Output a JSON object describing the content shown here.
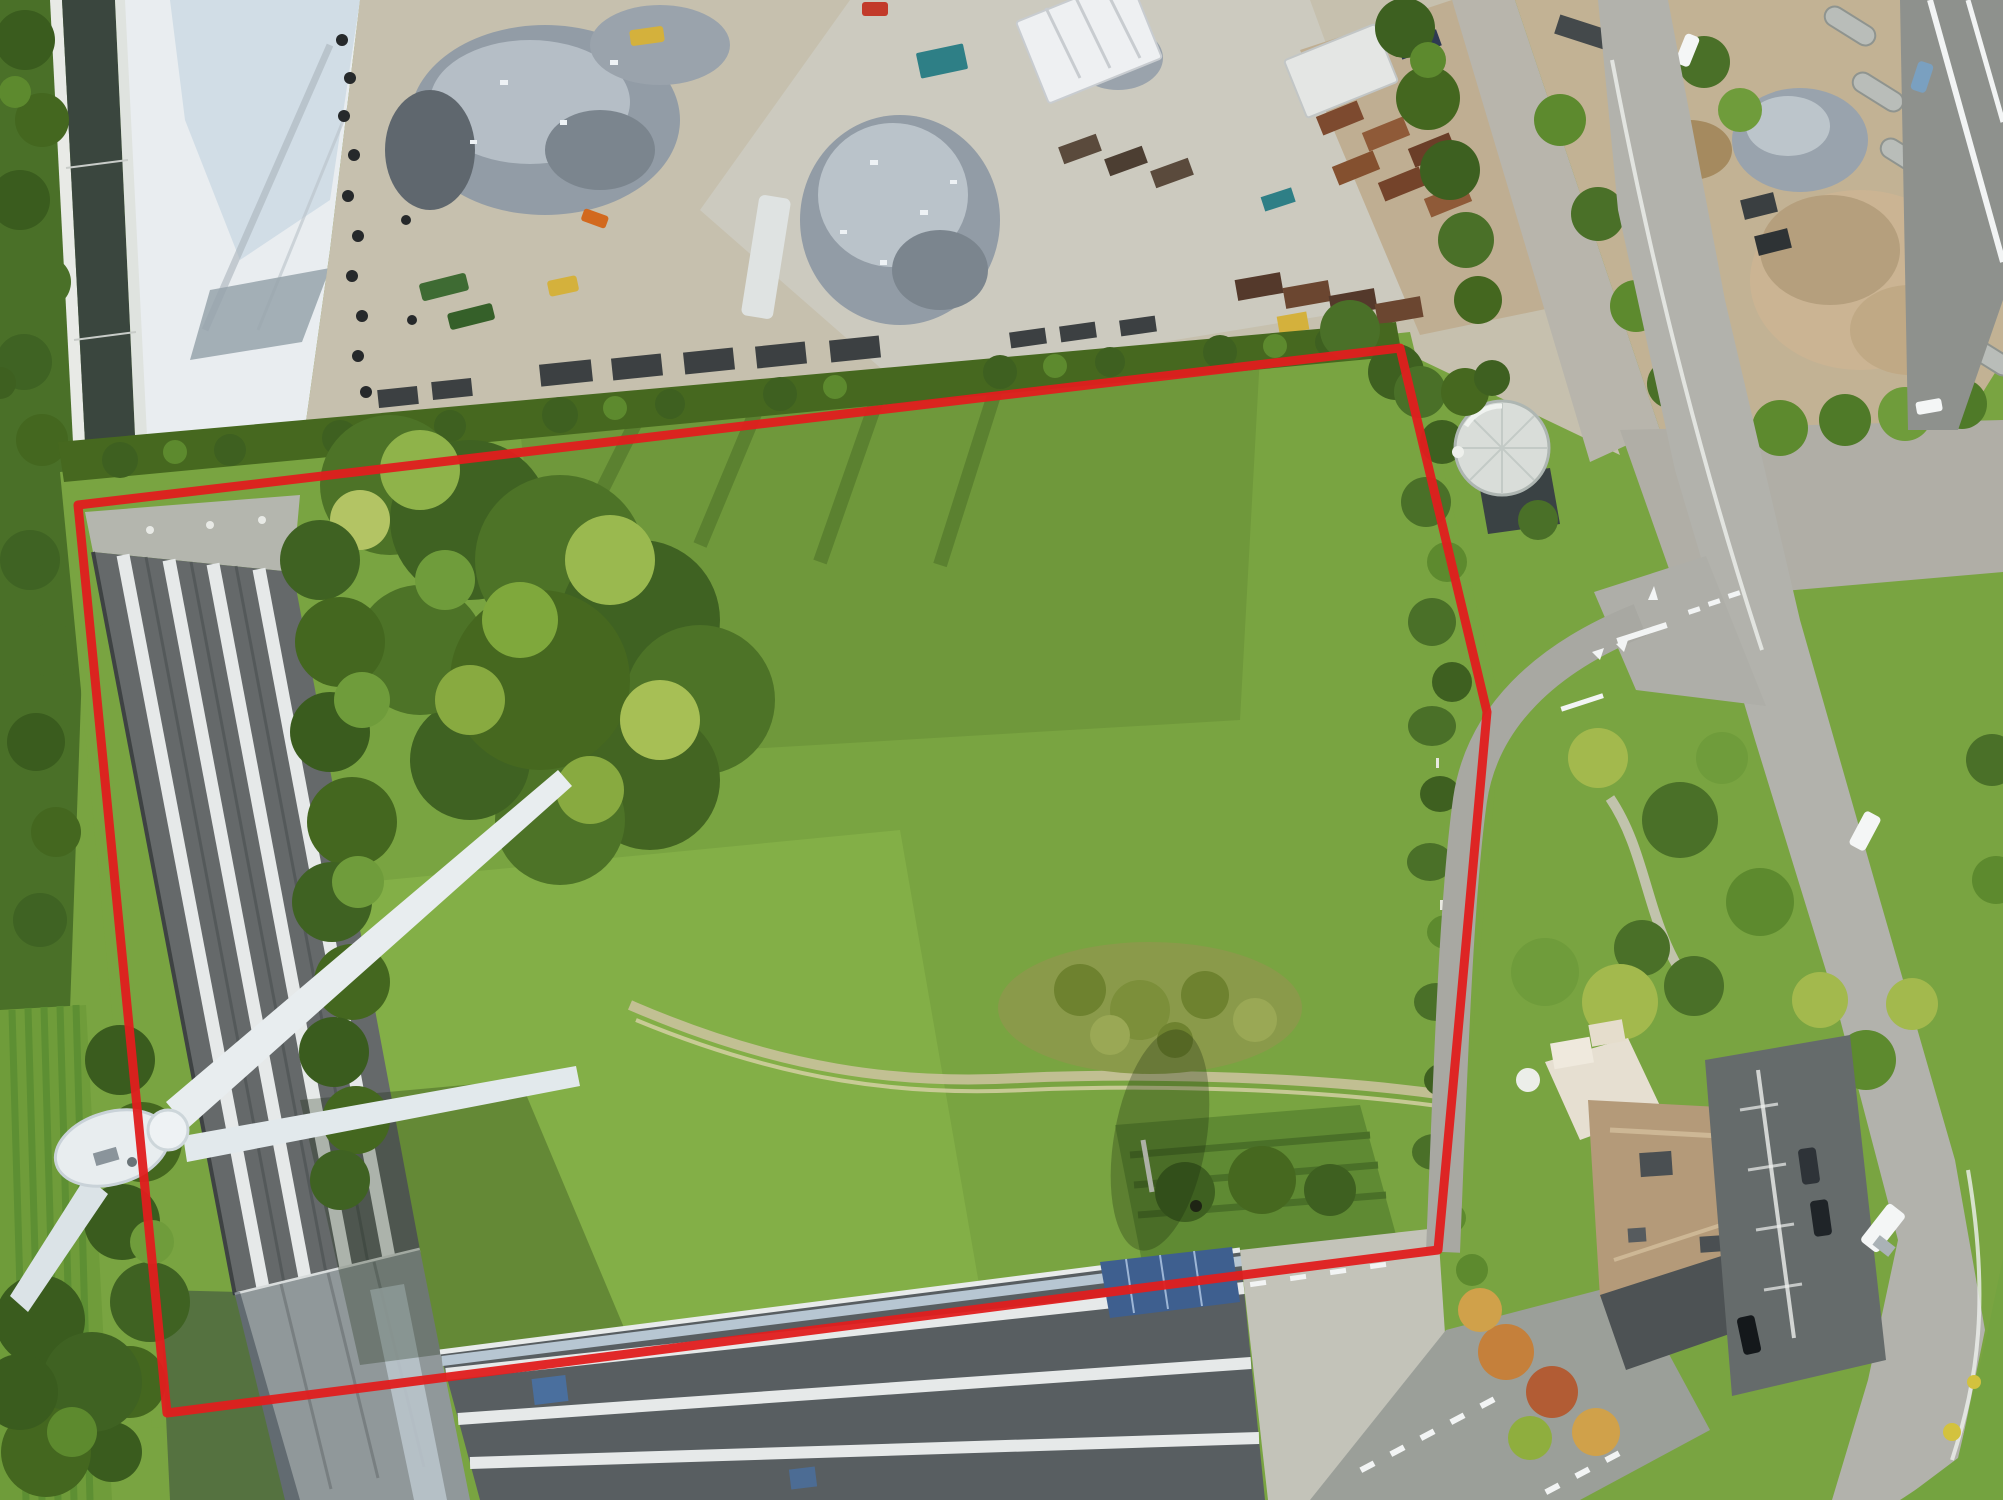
{
  "scene": {
    "type": "aerial-drone-photo",
    "description": "Aerial drone photograph of an industrial zone: a large grass parcel outlined with a red boundary line, a scrap-metal recycling yard at the top, a canal at the left, a wind turbine over a striped warehouse roof at lower left, roads, a round storage tank and houses at the right.",
    "parcel_boundary": {
      "color": "#e01d1d",
      "stroke_width": 9,
      "points": "78,505 1400,348 1487,712 1460,1010 1438,1250 167,1413"
    },
    "colors": {
      "field_grass": "#79a441",
      "meadow_light": "#8cb84c",
      "woodland": "#4d7327",
      "hedge": "#46681f",
      "canal_water": "#3a463e",
      "white_surface": "#e9edf0",
      "scrapyard_ground": "#c6c0ae",
      "concrete": "#cccabf",
      "scrap_metal": "#929ca6",
      "container_rust": "#7d4a2f",
      "road": "#b2b2ac",
      "asphalt_dark": "#656b6b",
      "warehouse_roof": "#65696a",
      "roof_stripe": "#e6e9e9",
      "south_building_roof": "#585e61",
      "solar_panel": "#3e5f8f",
      "house_roof": "#b49a79",
      "tank": "#d9ddd9",
      "turbine": "#e8edef",
      "vehicle_white": "#f4f6f6",
      "marking_white": "#f2f4f4"
    }
  }
}
